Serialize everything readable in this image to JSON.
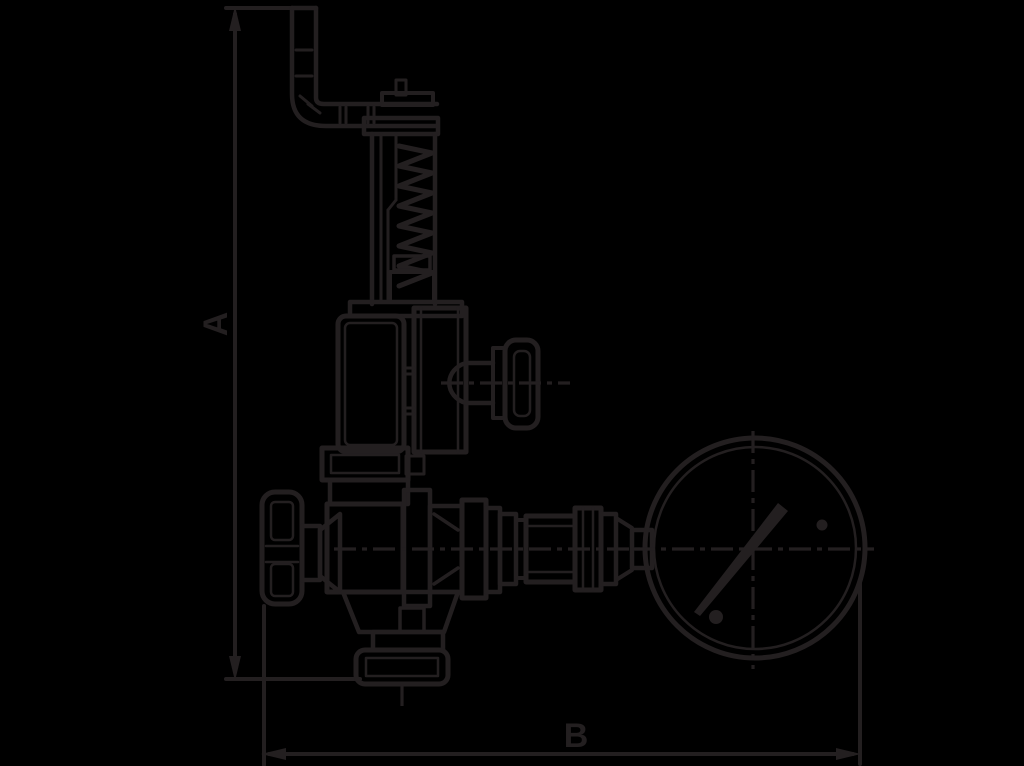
{
  "canvas": {
    "background_color": "#000000",
    "line_color": "#231f20",
    "width": 1024,
    "height": 766
  },
  "figure": {
    "type": "technical-line-drawing",
    "subject": "safety relief valve with test lever, spring bonnet, side and front handwheels, outlet piping and pressure gauge"
  },
  "dimension_labels": {
    "height": "A",
    "width": "B"
  }
}
